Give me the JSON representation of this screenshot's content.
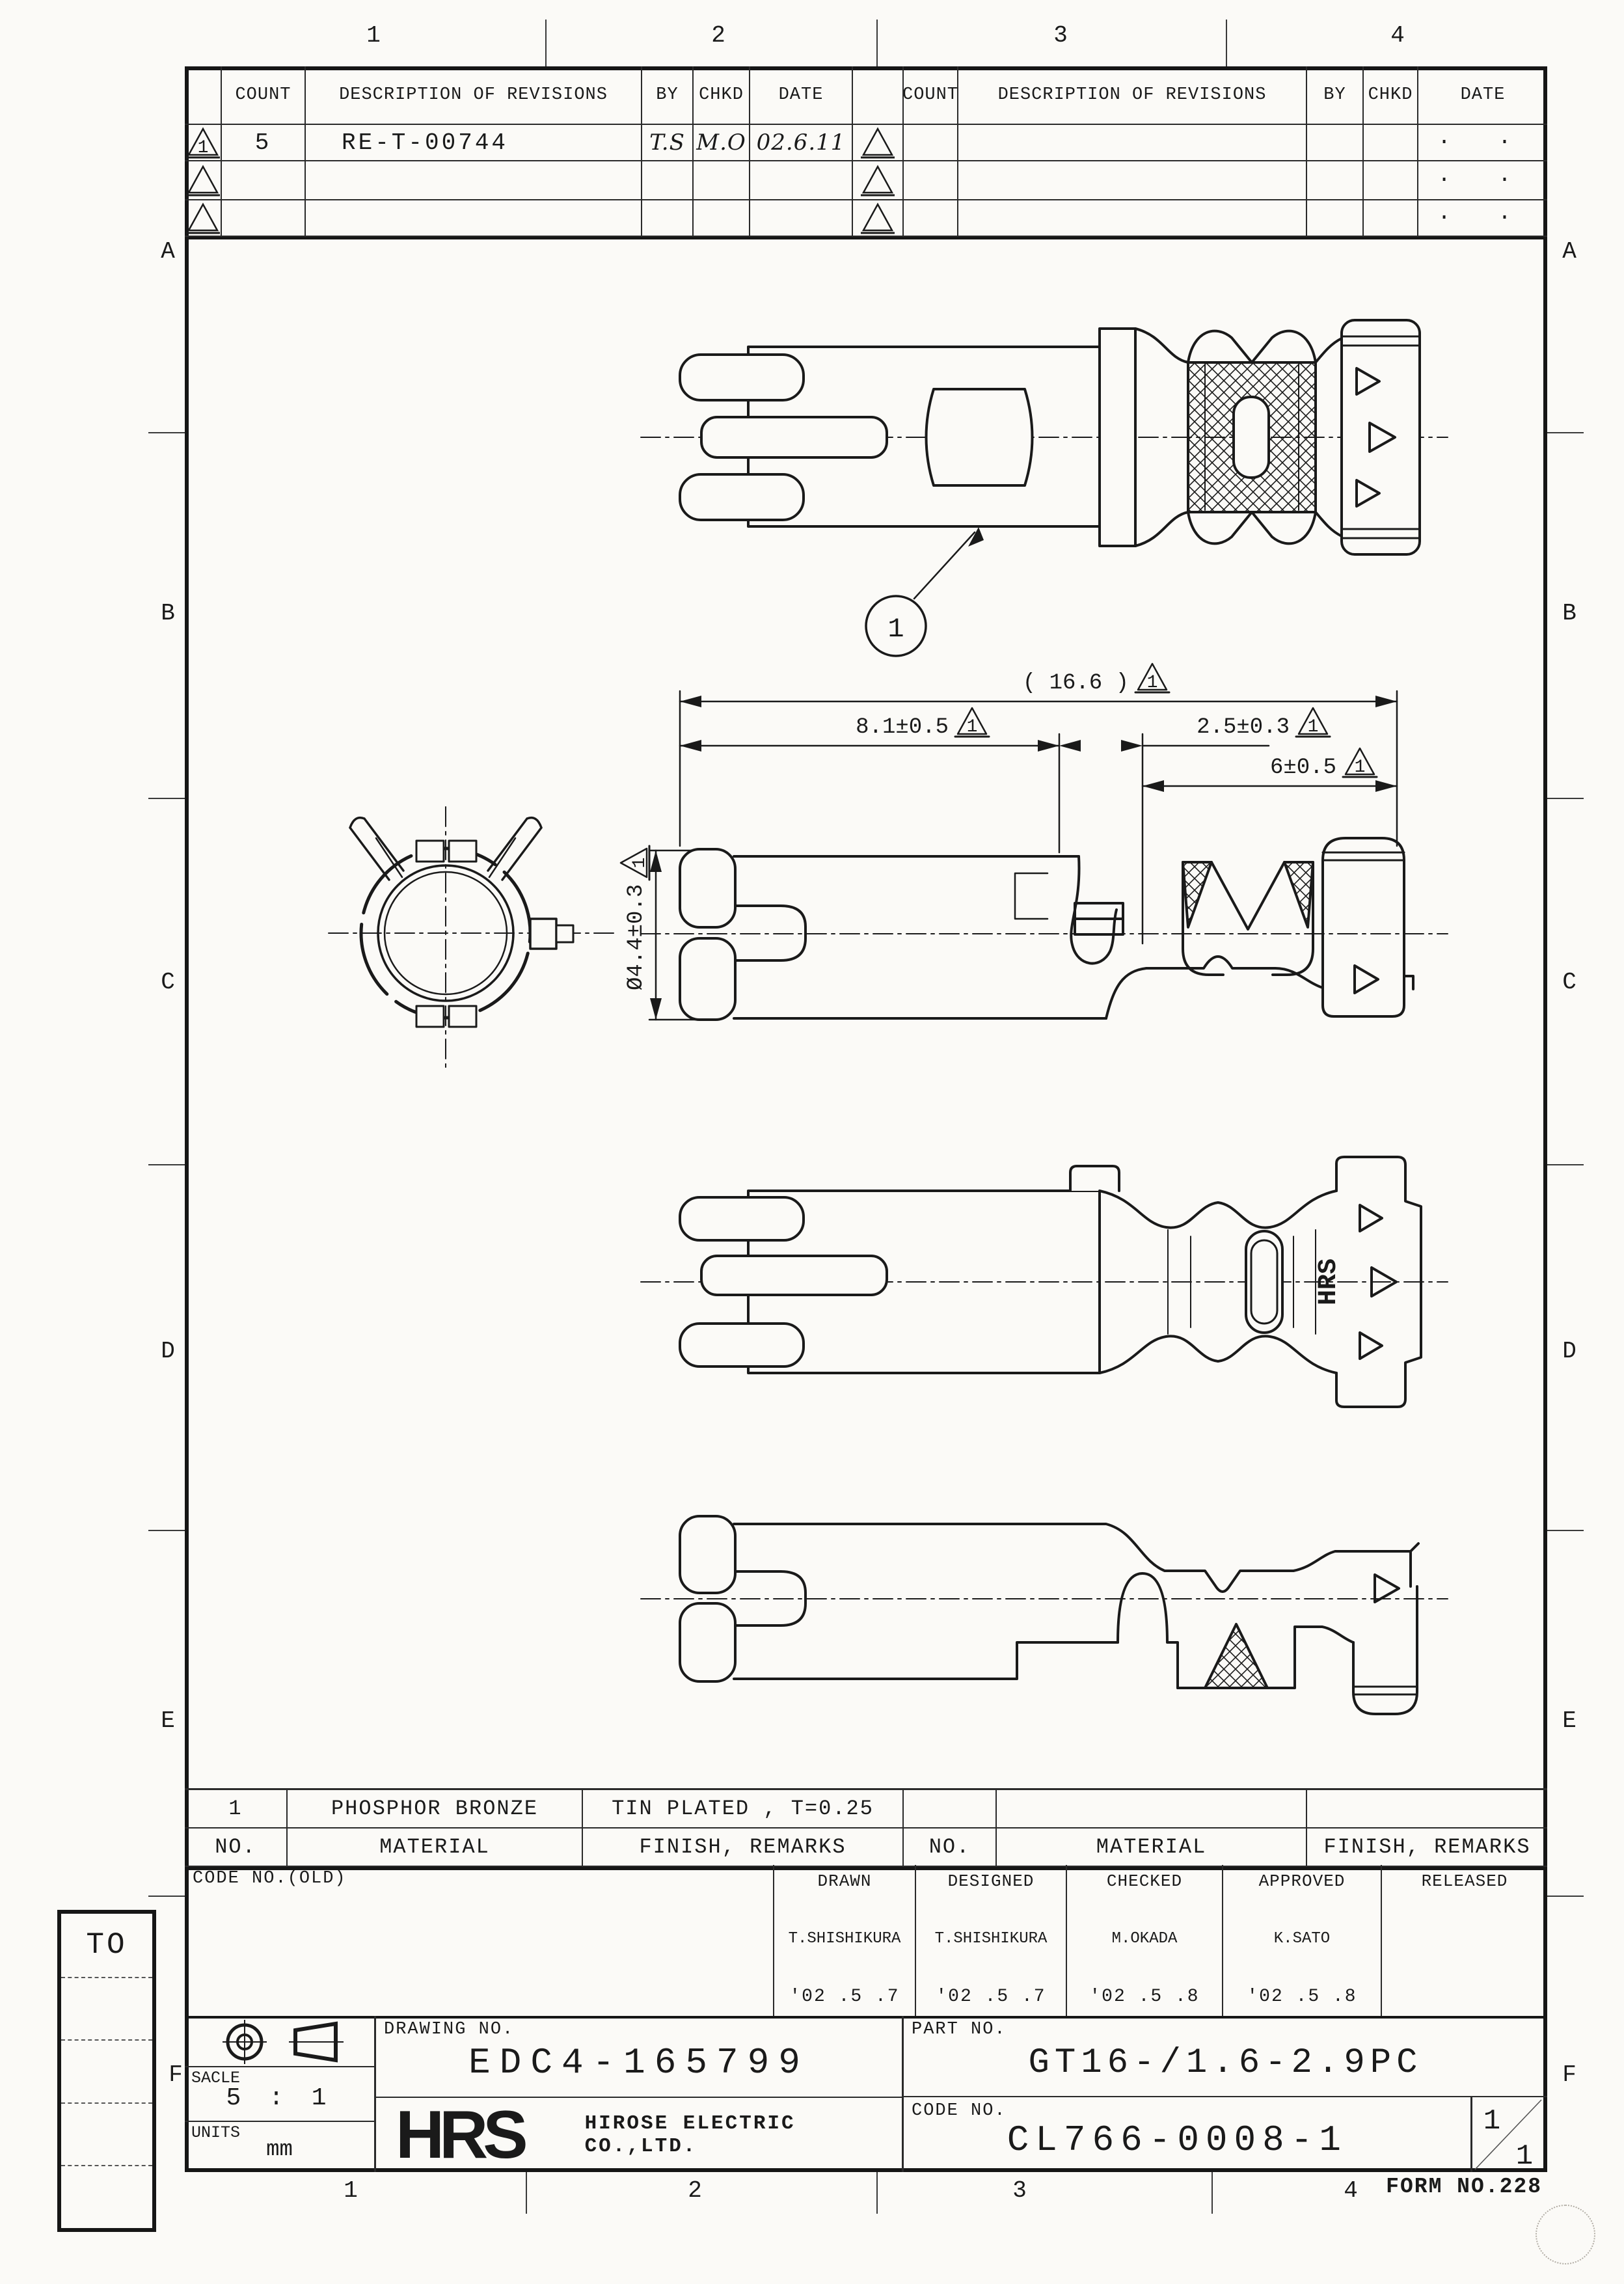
{
  "sheet": {
    "top_numbers": [
      "1",
      "2",
      "3",
      "4"
    ],
    "bottom_numbers": [
      "1",
      "2",
      "3",
      "4"
    ],
    "side_letters": [
      "A",
      "B",
      "C",
      "D",
      "E",
      "F"
    ],
    "form_no": "FORM NO.228"
  },
  "revision_table": {
    "count_label": "COUNT",
    "description_label": "DESCRIPTION OF REVISIONS",
    "by_label": "BY",
    "chkd_label": "CHKD",
    "date_label": "DATE",
    "flag_number": "1",
    "row1": {
      "count": "5",
      "description": "RE-T-00744",
      "by": "T.S",
      "chkd": "M.O",
      "date": "02.6.11"
    },
    "empty_date_dots": "· ·"
  },
  "drawing": {
    "callout_number": "1",
    "stamp": "HRS",
    "dim_overall": "( 16.6 )",
    "dim_left": "8.1±0.5",
    "dim_mid": "2.5±0.3",
    "dim_right": "6±0.5",
    "dim_diameter": "Ø4.4±0.3",
    "flag_number": "1"
  },
  "material_table": {
    "no_label": "NO.",
    "material_label": "MATERIAL",
    "finish_label": "FINISH, REMARKS",
    "row": {
      "no": "1",
      "material": "PHOSPHOR BRONZE",
      "finish": "TIN PLATED , T=0.25"
    }
  },
  "title_block": {
    "code_no_old_label": "CODE NO.(OLD)",
    "approvals": [
      {
        "label": "DRAWN",
        "name": "T.SHISHIKURA",
        "date": "'02 .5  .7"
      },
      {
        "label": "DESIGNED",
        "name": "T.SHISHIKURA",
        "date": "'02 .5  .7"
      },
      {
        "label": "CHECKED",
        "name": "M.OKADA",
        "date": "'02 .5  .8"
      },
      {
        "label": "APPROVED",
        "name": "K.SATO",
        "date": "'02 .5  .8"
      },
      {
        "label": "RELEASED",
        "name": "",
        "date": ""
      }
    ],
    "scale_label": "SACLE",
    "scale_value": "5 : 1",
    "units_label": "UNITS",
    "units_value": "mm",
    "drawing_no_label": "DRAWING NO.",
    "drawing_no": "EDC4-165799",
    "logo": "HRS",
    "company": "HIROSE ELECTRIC CO.,LTD.",
    "part_no_label": "PART NO.",
    "part_no": "GT16-/1.6-2.9PC",
    "code_no_label": "CODE NO.",
    "code_no": "CL766-0008-1",
    "sheet_current": "1",
    "sheet_total": "1"
  },
  "to_box": {
    "label": "TO"
  }
}
